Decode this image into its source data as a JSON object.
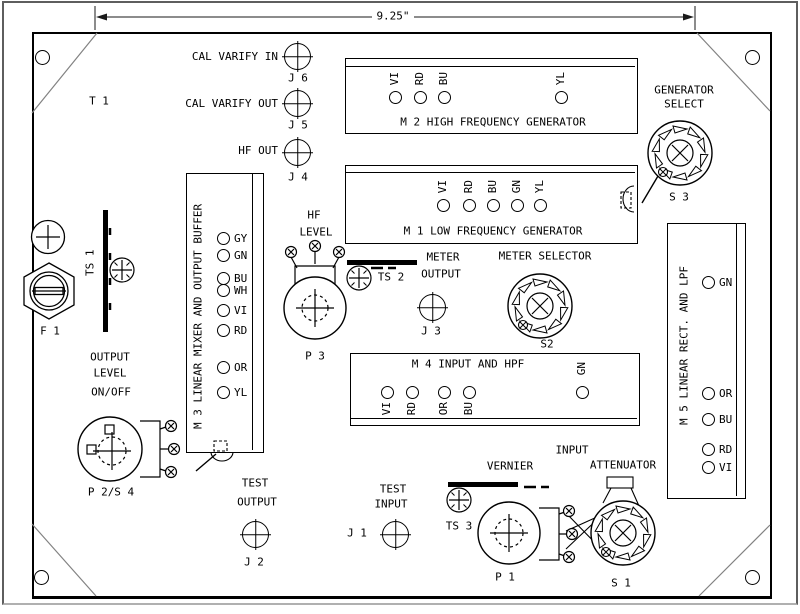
{
  "dimension": {
    "width_label": "9.25\""
  },
  "colors": {
    "line": "#000000",
    "bevel_line": "#808080",
    "frame": "#5e5e5e"
  },
  "panel": {
    "transformer_ref": "T 1",
    "fuse_ref": "F 1",
    "jacks": {
      "j6": {
        "label": "CAL VARIFY IN",
        "ref": "J 6"
      },
      "j5": {
        "label": "CAL VARIFY OUT",
        "ref": "J 5"
      },
      "j4": {
        "label": "HF OUT",
        "ref": "J 4"
      },
      "j3": {
        "label_line1": "METER",
        "label_line2": "OUTPUT",
        "ref": "J 3"
      },
      "j2": {
        "label_line1": "TEST",
        "label_line2": "OUTPUT",
        "ref": "J 2"
      },
      "j1": {
        "label_line1": "TEST",
        "label_line2": "INPUT",
        "ref": "J 1"
      }
    },
    "modules": {
      "m2": {
        "title": "M 2 HIGH FREQUENCY GENERATOR",
        "leds": [
          "VI",
          "RD",
          "BU",
          "YL"
        ]
      },
      "m1": {
        "title": "M 1 LOW FREQUENCY GENERATOR",
        "leds": [
          "VI",
          "RD",
          "BU",
          "GN",
          "YL"
        ]
      },
      "m3": {
        "title": "M 3 LINEAR MIXER AND OUTPUT BUFFER",
        "leds": [
          "GY",
          "GN",
          "BU",
          "WH",
          "VI",
          "RD",
          "OR",
          "YL"
        ]
      },
      "m4": {
        "title": "M 4 INPUT AND HPF",
        "leds_bottom": [
          "VI",
          "RD",
          "OR",
          "BU"
        ],
        "led_right": "GN"
      },
      "m5": {
        "title": "M 5 LINEAR RECT. AND LPF",
        "leds": [
          "GN",
          "OR",
          "BU",
          "RD",
          "VI"
        ]
      }
    },
    "controls": {
      "generator_select": {
        "label_line1": "GENERATOR",
        "label_line2": "SELECT",
        "ref": "S 3"
      },
      "meter_selector": {
        "label": "METER SELECTOR",
        "ref": "S2"
      },
      "hf_level": {
        "label_line1": "HF",
        "label_line2": "LEVEL",
        "ref": "P 3"
      },
      "output_level": {
        "label_line1": "OUTPUT",
        "label_line2": "LEVEL",
        "label_line3": "ON/OFF",
        "ref": "P 2/S 4"
      },
      "vernier": {
        "label": "VERNIER",
        "ref": "P 1"
      },
      "input_attenuator": {
        "label_line1": "INPUT",
        "label_line2": "ATTENUATOR",
        "ref": "S 1"
      }
    },
    "terminal_strips": {
      "ts1": "TS 1",
      "ts2": "TS 2",
      "ts3": "TS 3"
    }
  }
}
